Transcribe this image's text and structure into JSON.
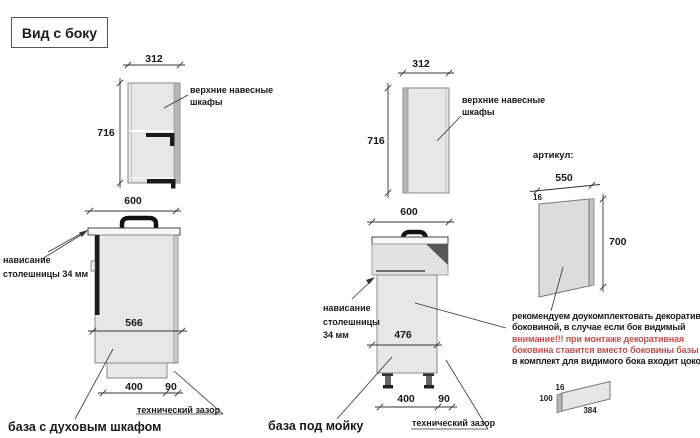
{
  "title": "Вид с боку",
  "colors": {
    "accent_red": "#c0504d",
    "cabinet_fill": "#e7e7e7",
    "cabinet_edge": "#8a8a8a"
  },
  "left_section": {
    "upper_cabinet": {
      "width": "312",
      "height": "716",
      "label": "верхние навесные\nшкафы"
    },
    "base_cabinet": {
      "caption": "база с духовым шкафом",
      "width": "600",
      "inner_depth": "566",
      "plinth_depth": "400",
      "gap": "90",
      "overhang_label": "нависание\nстолешницы 34 мм",
      "gap_label": "технический зазор"
    }
  },
  "middle_section": {
    "upper_cabinet": {
      "width": "312",
      "height": "716",
      "label": "верхние навесные\nшкафы"
    },
    "base_cabinet": {
      "caption": "база под мойку",
      "width": "600",
      "inner_depth": "476",
      "plinth_depth": "400",
      "gap": "90",
      "overhang_label": "нависание\nстолешницы\n34 мм",
      "gap_label": "технический зазор"
    }
  },
  "right_section": {
    "heading": "артикул:",
    "side_panel": {
      "width": "550",
      "thickness": "16",
      "height": "700"
    },
    "note": {
      "lines": [
        {
          "text": "рекомендуем доукомплектовать декоративной",
          "color": "black"
        },
        {
          "text": "боковиной, в случае если бок видимый",
          "color": "black"
        },
        {
          "text": "внимание!!! при монтаже декоративная",
          "color": "red"
        },
        {
          "text": "боковина ставится вместо боковины базы лдсп",
          "color": "red"
        },
        {
          "text": "в комплект для видимого бока входит цоколь:",
          "color": "black"
        }
      ]
    },
    "plinth": {
      "thickness": "16",
      "height": "100",
      "length": "384"
    }
  }
}
